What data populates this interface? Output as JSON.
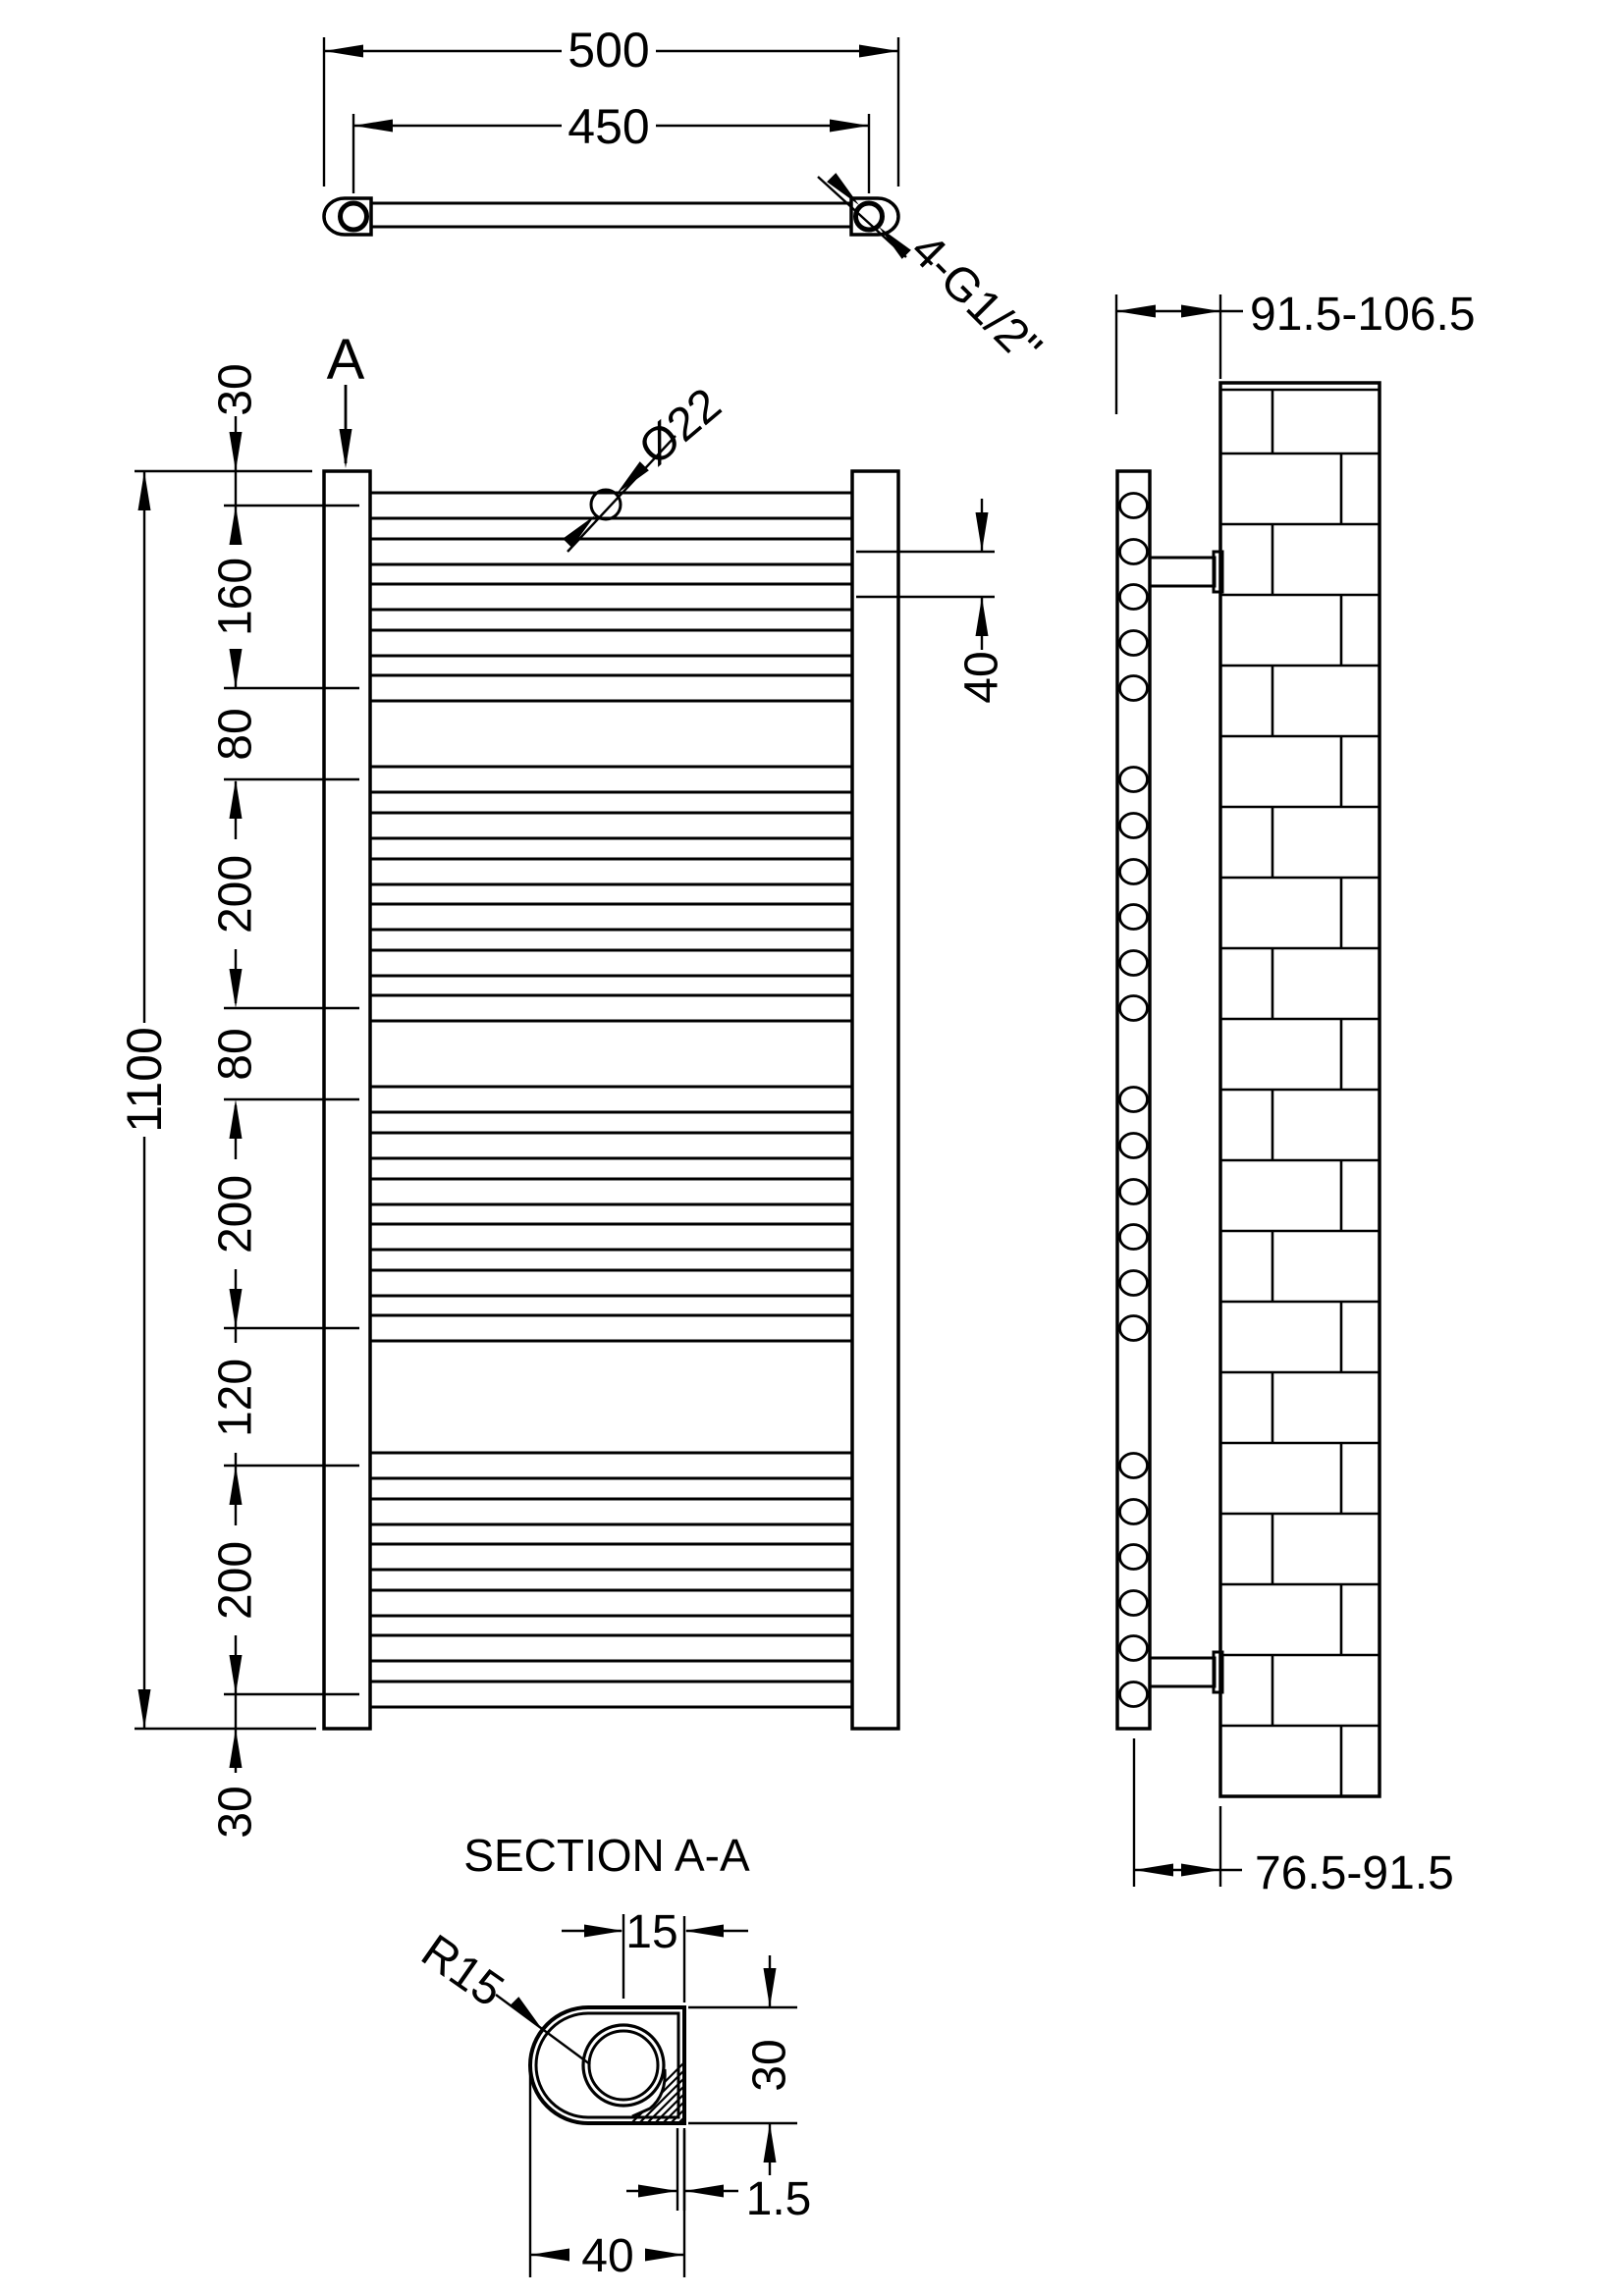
{
  "drawing": {
    "background": "#ffffff",
    "line_color": "#000000",
    "top": {
      "overall_width": "500",
      "tapping_centres": "450",
      "connections": "4-G1/2\""
    },
    "front": {
      "overall_height": "1100",
      "segments": [
        "30",
        "160",
        "80",
        "200",
        "80",
        "200",
        "120",
        "200",
        "30"
      ],
      "tube_diameter": "Ø22",
      "tube_pitch": "40",
      "section_marker": "A"
    },
    "side": {
      "wall_to_front": "91.5-106.5",
      "wall_to_centre": "76.5-91.5"
    },
    "section": {
      "title": "SECTION A-A",
      "radius": "R15",
      "centre_offset": "15",
      "depth": "30",
      "wall_thickness": "1.5",
      "width": "40"
    },
    "tube_centers_mm": [
      30,
      70,
      110,
      150,
      190,
      270,
      310,
      350,
      390,
      430,
      470,
      550,
      590,
      630,
      670,
      710,
      750,
      870,
      910,
      950,
      990,
      1030,
      1070
    ],
    "chain_boundaries_mm": [
      0,
      30,
      190,
      270,
      470,
      550,
      750,
      870,
      1070,
      1100
    ]
  }
}
